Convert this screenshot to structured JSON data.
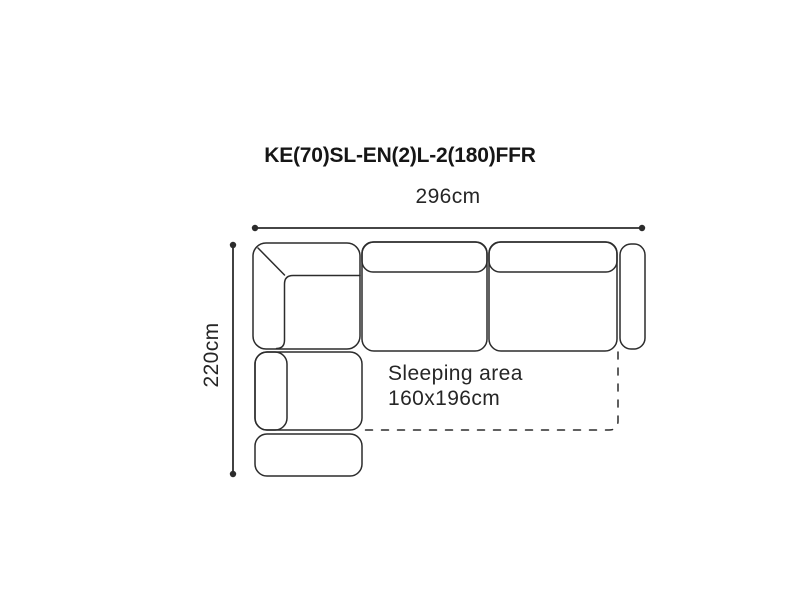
{
  "diagram": {
    "title": "KE(70)SL-EN(2)L-2(180)FFR",
    "width_dimension": "296cm",
    "height_dimension": "220cm",
    "sleeping_area": {
      "line1": "Sleeping area",
      "line2": "160x196cm"
    },
    "colors": {
      "line": "#2c2c2c",
      "text": "#262626",
      "title_text": "#161616",
      "background": "#ffffff"
    }
  }
}
